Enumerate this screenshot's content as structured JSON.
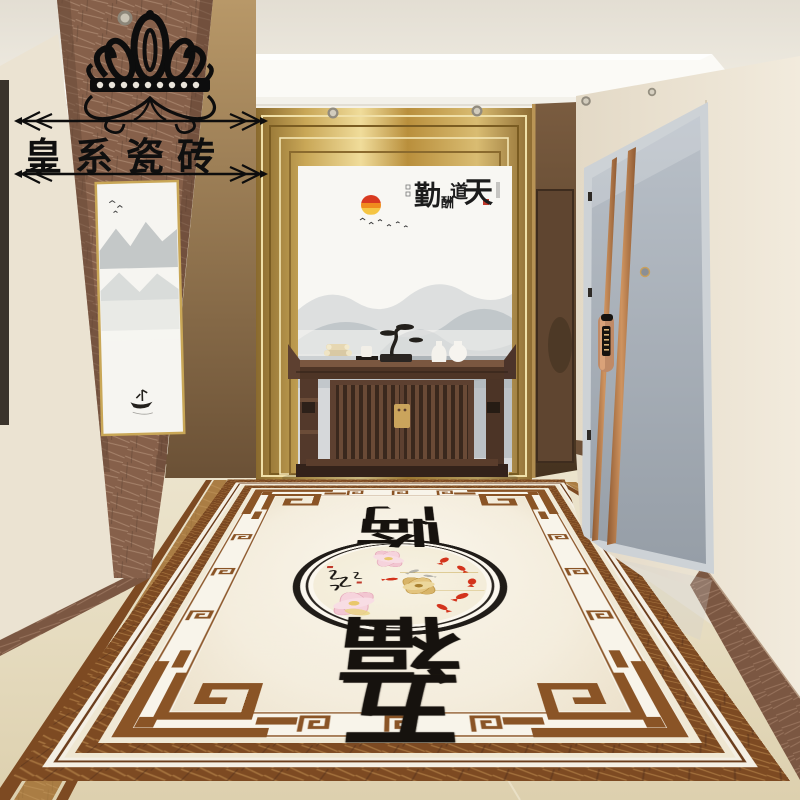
{
  "watermark": {
    "brand_text": "皇系瓷砖",
    "icon": "crown-flourish-icon",
    "text_color": "#0f0f0f",
    "arrow_style": "double-chevron-both-ends"
  },
  "back_wall": {
    "panel_gold_color": "#c9a757",
    "mural": {
      "phrase": "天道酬勤",
      "reading": "right-to-left",
      "display_left_to_right": [
        "勤",
        "酬",
        "道",
        "天"
      ],
      "ink_color": "#1c1c1c",
      "seal_color": "#c0392b",
      "sun_colors": [
        "#d93a20",
        "#f08c1e",
        "#f5c543"
      ],
      "motifs": [
        "ink-wash-mountains",
        "mist",
        "flying-birds",
        "red-sun"
      ]
    }
  },
  "side_painting": {
    "name": "ink-wash-scroll",
    "motifs": [
      "mountains",
      "birds",
      "boatman"
    ],
    "frame_color": "#c9a757"
  },
  "console_table": {
    "wood_color": "#5d4030",
    "items": [
      "scroll-bundle",
      "tea-cup-on-tray",
      "bonsai-sculpture",
      "white-vase-tall",
      "white-vase-round"
    ],
    "hardware_color": "#caa45c"
  },
  "entry_door": {
    "leaf_color": "#a7afb8",
    "stripe_color": "#b5774a",
    "lock_color": "#c08a66",
    "hardware": [
      "peephole",
      "smart-lock",
      "hinges"
    ]
  },
  "inner_door": {
    "color": "#5f4530"
  },
  "floor_carpet": {
    "phrase": "五福临门",
    "reading": "bottom-to-top",
    "chars_bottom_to_top": [
      "五",
      "福",
      "临",
      "门"
    ],
    "medallion": {
      "motifs": [
        "pink-lotus",
        "gold-lotus",
        "koi-fish",
        "calligraphy-script",
        "red-seals"
      ],
      "fish_color": "#d3331c",
      "lotus_pink": "#f0c6d2",
      "lotus_gold": "#d0a658"
    },
    "border": {
      "outer_band": "#7d4a22",
      "meander": "#8a5426",
      "field": "#f7f2e6"
    }
  },
  "palette": {
    "ceiling": "#eae6dd",
    "cove_light": "#fbfaf6",
    "wall_cream": "#ece4d4",
    "marble_brown": "#8a6a55",
    "gold": "#c9a757",
    "floor_beige": "#e6ddc2",
    "door_gray": "#a7afb8"
  }
}
